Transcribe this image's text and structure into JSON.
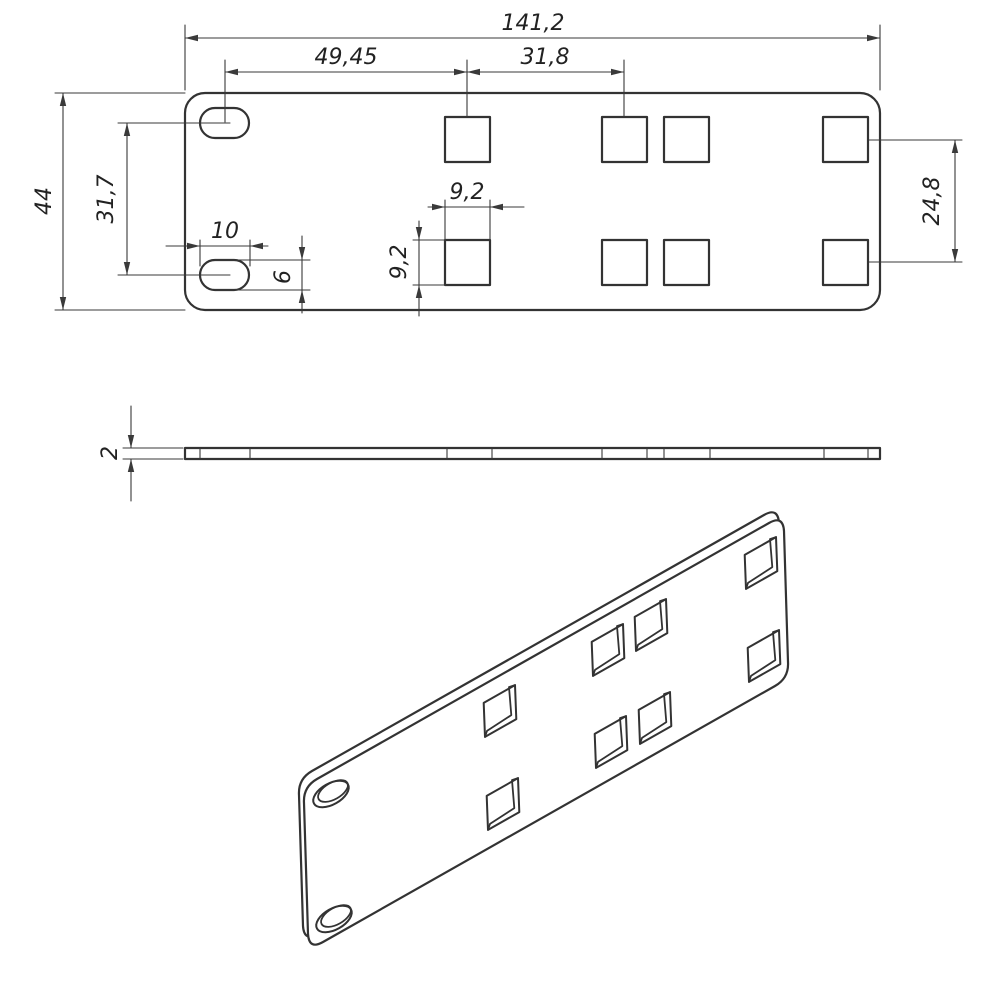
{
  "drawing": {
    "background_color": "#ffffff",
    "line_color": "#333333",
    "views": {
      "top": {
        "name": "top view",
        "dims": {
          "overall_length": "141,2",
          "slot_to_first_hole": "49,45",
          "hole_column_pitch": "31,8",
          "overall_width": "44",
          "slot_row_pitch": "31,7",
          "slot_length": "10",
          "slot_width": "6",
          "hole_width": "9,2",
          "hole_height": "9,2",
          "right_hole_row_pitch": "24,8"
        }
      },
      "side": {
        "name": "side view",
        "dims": {
          "thickness": "2"
        }
      },
      "isometric": {
        "name": "isometric view"
      }
    }
  }
}
